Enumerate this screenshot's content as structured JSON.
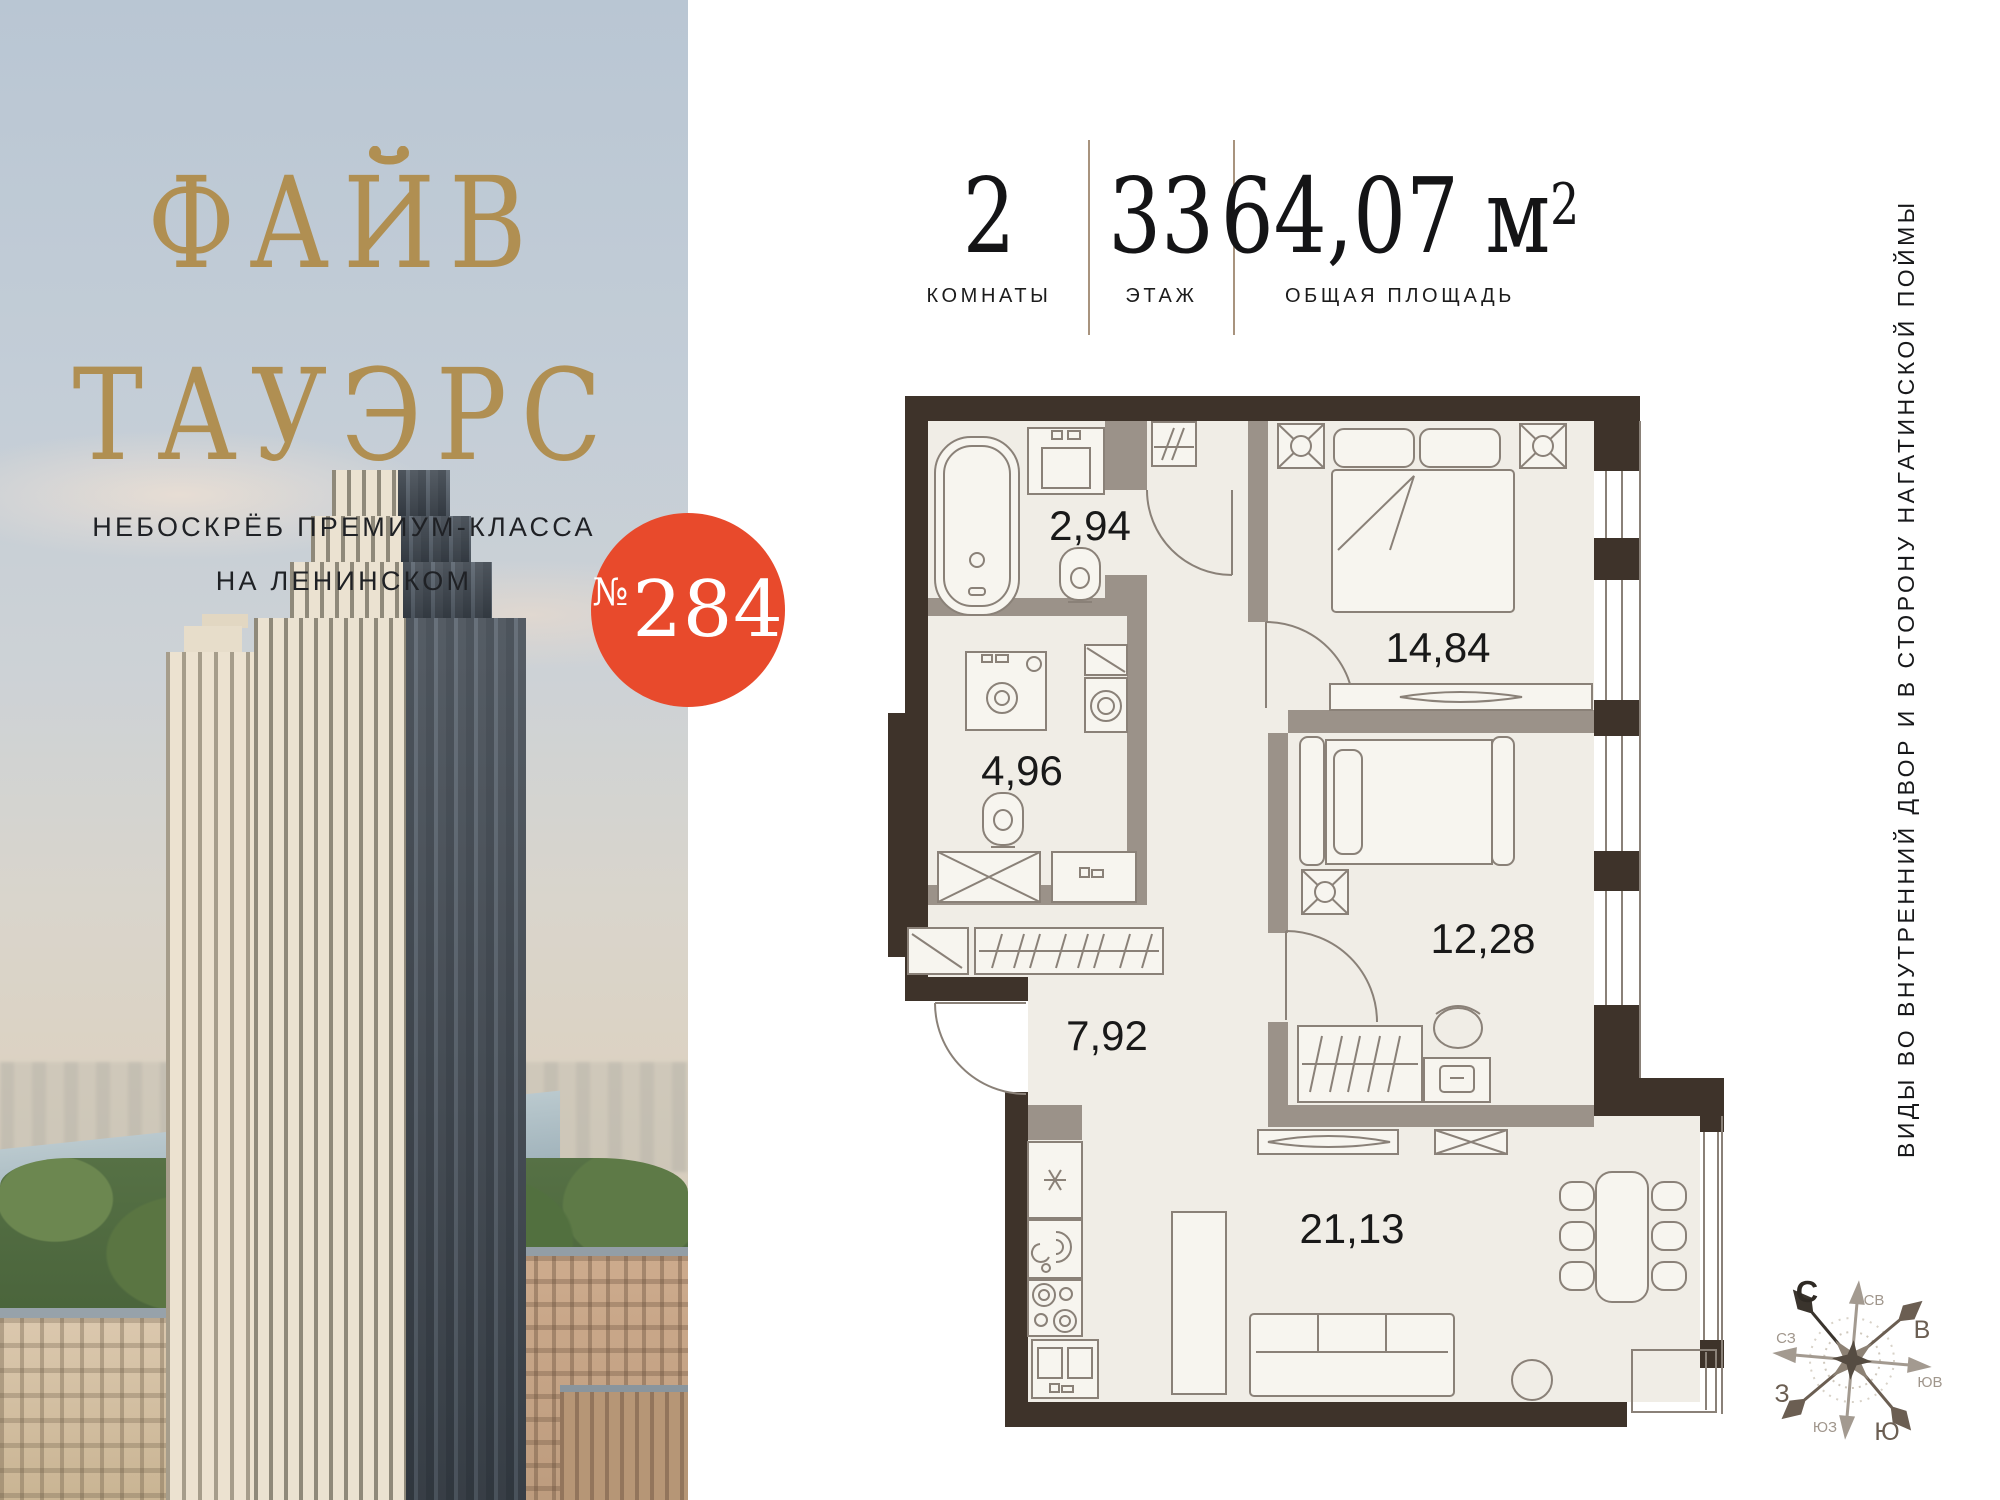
{
  "brand": {
    "title_line1": "ФАЙВ",
    "title_line2": "ТАУЭРС",
    "subtitle_line1": "НЕБОСКРЁБ ПРЕМИУМ-КЛАССА",
    "subtitle_line2": "НА ЛЕНИНСКОМ"
  },
  "badge": {
    "prefix": "№",
    "number": "284"
  },
  "stats": {
    "items": [
      {
        "value": "2",
        "label": "КОМНАТЫ"
      },
      {
        "value": "33",
        "label": "ЭТАЖ"
      },
      {
        "value": "64,07 м",
        "sup": "2",
        "label": "ОБЩАЯ ПЛОЩАДЬ"
      }
    ]
  },
  "floorplan": {
    "rooms": [
      {
        "name": "bathroom",
        "area": "2,94"
      },
      {
        "name": "bathroom-2",
        "area": "4,96"
      },
      {
        "name": "bedroom",
        "area": "14,84"
      },
      {
        "name": "bedroom-2",
        "area": "12,28"
      },
      {
        "name": "hallway",
        "area": "7,92"
      },
      {
        "name": "kitchen-living",
        "area": "21,13"
      }
    ]
  },
  "note": {
    "text": "ВИДЫ ВО ВНУТРЕННИЙ ДВОР И В СТОРОНУ НАГАТИНСКОЙ ПОЙМЫ"
  },
  "compass": {
    "directions": [
      {
        "label": "С"
      },
      {
        "label": "СВ"
      },
      {
        "label": "В"
      },
      {
        "label": "ЮВ"
      },
      {
        "label": "Ю"
      },
      {
        "label": "ЮЗ"
      },
      {
        "label": "З"
      },
      {
        "label": "СЗ"
      }
    ]
  },
  "colors": {
    "brand_gold": "#b08f52",
    "badge_red": "#e84a2c",
    "wall_dark": "#3e332a",
    "partition_gray": "#9b9289",
    "floor": "#f0ede6",
    "divider_tan": "#a8937e"
  }
}
